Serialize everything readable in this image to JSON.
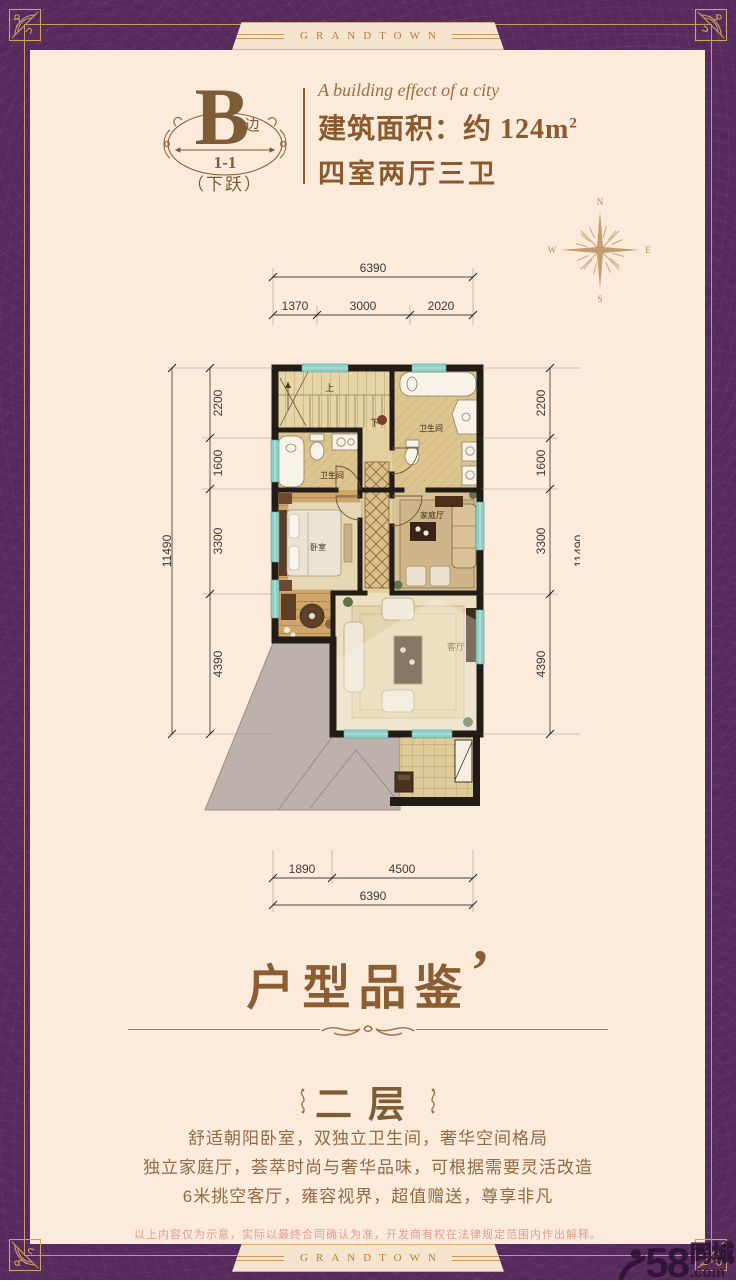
{
  "brand": {
    "ribbon_text": "GRANDTOWN"
  },
  "header": {
    "unit_letter": "B",
    "unit_suffix": "边",
    "unit_number": "1-1",
    "unit_note": "（下跃）",
    "tagline": "A building effect of a city",
    "area_label": "建筑面积：约 124m",
    "area_sup": "2",
    "layout_line": "四室两厅三卫"
  },
  "compass": {
    "n": "N",
    "e": "E",
    "s": "S",
    "w": "W"
  },
  "floorplan": {
    "dims_top": {
      "total": "6390",
      "segments": [
        "1370",
        "3000",
        "2020"
      ]
    },
    "dims_bottom": {
      "total": "6390",
      "segments": [
        "1890",
        "4500"
      ]
    },
    "dims_left": {
      "total": "11490",
      "segments": [
        "2200",
        "1600",
        "3300",
        "4390"
      ]
    },
    "dims_right": {
      "total": "11490",
      "segments": [
        "2200",
        "1600",
        "3300",
        "4390"
      ]
    },
    "rooms": {
      "bath_right": "卫生间",
      "bath_left": "卫生间",
      "bedroom": "卧室",
      "family": "家庭厅",
      "living": "客厅"
    },
    "stairs": {
      "up": "上",
      "down": "下"
    }
  },
  "section": {
    "title": "户型品鉴",
    "title_quote": "’",
    "floor_label": "二层",
    "desc_lines": [
      "舒适朝阳卧室，双独立卫生间，奢华空间格局",
      "独立家庭厅，荟萃时尚与奢华品味，可根据需要灵活改造",
      "6米挑空客厅，雍容视界，超值赠送，尊享非凡"
    ]
  },
  "footer": {
    "disclaimer": "以上内容仅为示意，实际以最终合同确认为准，开发商有权在法律规定范围内作出解释。",
    "watermark_number": "58",
    "watermark_domain": ".com",
    "watermark_cn": "同城"
  },
  "colors": {
    "purple": "#572a5d",
    "cream": "#fceadb",
    "gold": "#c9995c",
    "brown": "#8a5a2e"
  }
}
